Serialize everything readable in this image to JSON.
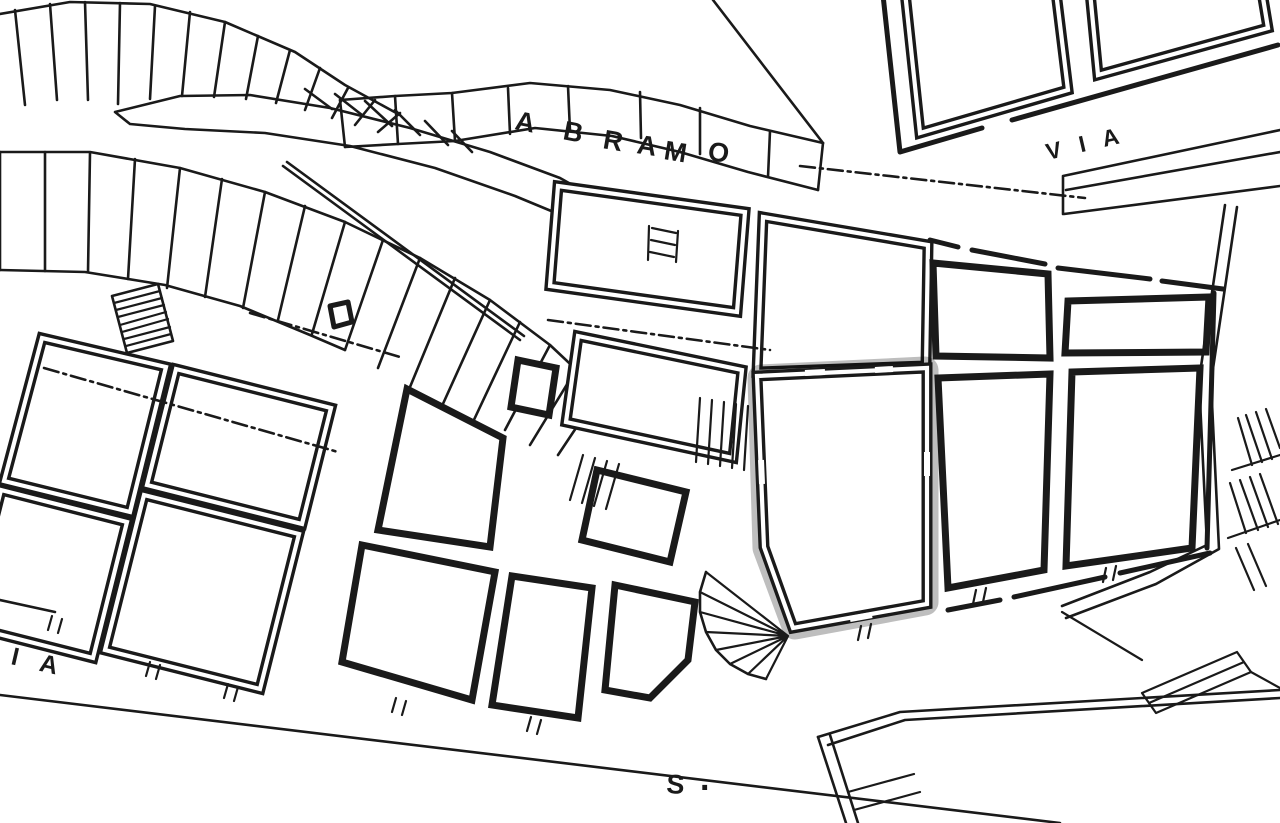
{
  "map": {
    "type": "cadastral-town-plan-scan",
    "labels": {
      "abramo": {
        "street_name_readout": "ABRAMO",
        "letters": [
          "A",
          "B",
          "R",
          "A",
          "M",
          "O"
        ]
      },
      "via_top_right": "V I A",
      "via_bottom_left": "I A",
      "s_bottom": "S",
      "s_bottom_dot": "."
    },
    "colors": {
      "paper": "#ffffff",
      "ink": "#1a1a1a",
      "highlight": "#b9b9b9"
    }
  }
}
